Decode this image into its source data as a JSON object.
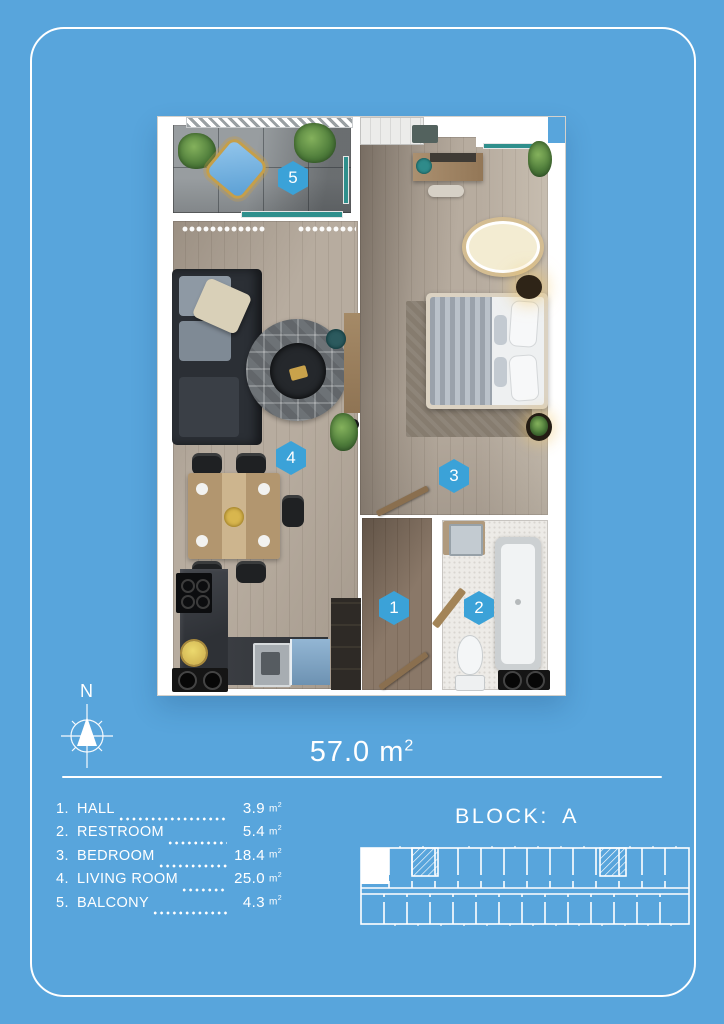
{
  "colors": {
    "background_blue": "#58a5dc",
    "marker_blue": "#3ba2d8",
    "text_white": "#ffffff",
    "window_teal": "#2f8f8c"
  },
  "compass": {
    "label": "N"
  },
  "area": {
    "value": "57.0",
    "unit": "m",
    "exp": "2"
  },
  "plan": {
    "markers": [
      {
        "number": "1",
        "room": "hall"
      },
      {
        "number": "2",
        "room": "restroom"
      },
      {
        "number": "3",
        "room": "bedroom"
      },
      {
        "number": "4",
        "room": "living-room"
      },
      {
        "number": "5",
        "room": "balcony"
      }
    ]
  },
  "rooms": [
    {
      "num": "1.",
      "name": "HALL",
      "area": "3.9",
      "unit": "m",
      "exp": "2"
    },
    {
      "num": "2.",
      "name": "RESTROOM",
      "area": "5.4",
      "unit": "m",
      "exp": "2"
    },
    {
      "num": "3.",
      "name": "BEDROOM",
      "area": "18.4",
      "unit": "m",
      "exp": "2"
    },
    {
      "num": "4.",
      "name": "LIVING ROOM",
      "area": "25.0",
      "unit": "m",
      "exp": "2"
    },
    {
      "num": "5.",
      "name": "BALCONY",
      "area": "4.3",
      "unit": "m",
      "exp": "2"
    }
  ],
  "block": {
    "label": "BLOCK: A"
  },
  "key_plan": {
    "highlighted_unit": "top-left"
  }
}
